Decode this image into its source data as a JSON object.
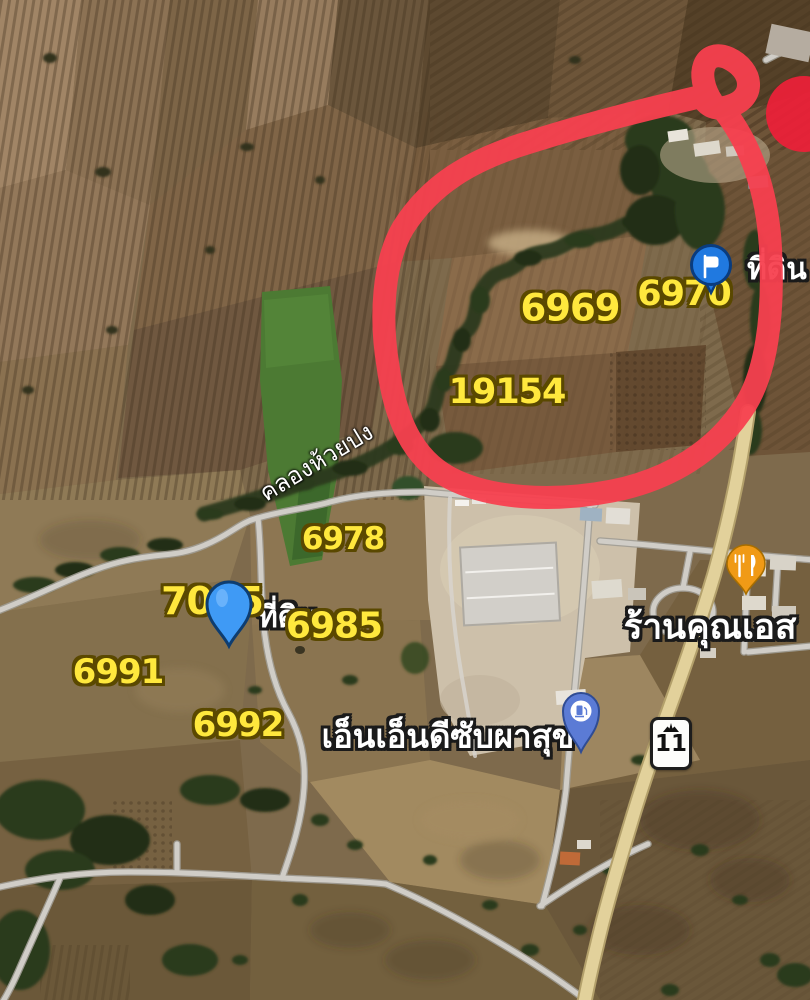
{
  "map": {
    "type": "satellite",
    "parcels": [
      {
        "text": "6969"
      },
      {
        "text": "6970"
      },
      {
        "text": "19154"
      },
      {
        "text": "6978"
      },
      {
        "text": "7045"
      },
      {
        "text": "6985"
      },
      {
        "text": "6991"
      },
      {
        "text": "6992"
      }
    ],
    "places": {
      "land_top": "ที่ดิน",
      "land_mid": "ที่ดิน",
      "canal": "คลองห้วยปง",
      "company": "เอ็นเอ็นดีซับผาสุข",
      "shop": "ร้านคุณเอส"
    },
    "route_shield": {
      "number": "11"
    },
    "markers": [
      {
        "name": "saved-flag-marker",
        "color": "#2079e0"
      },
      {
        "name": "parcel-pin-marker",
        "color": "#3f9af5"
      },
      {
        "name": "restaurant-pin-marker",
        "color": "#f09a16"
      },
      {
        "name": "gas-station-pin-marker",
        "color": "#5b7bd5"
      }
    ],
    "annotation": {
      "type": "hand-drawn-circle",
      "color": "#f7404f"
    },
    "colors": {
      "parcel_text": "#ffe83d",
      "parcel_outline": "#5a4800",
      "poi_text": "#ffffff",
      "highway": "#e2d19b",
      "road": "#d0cdc7"
    }
  }
}
